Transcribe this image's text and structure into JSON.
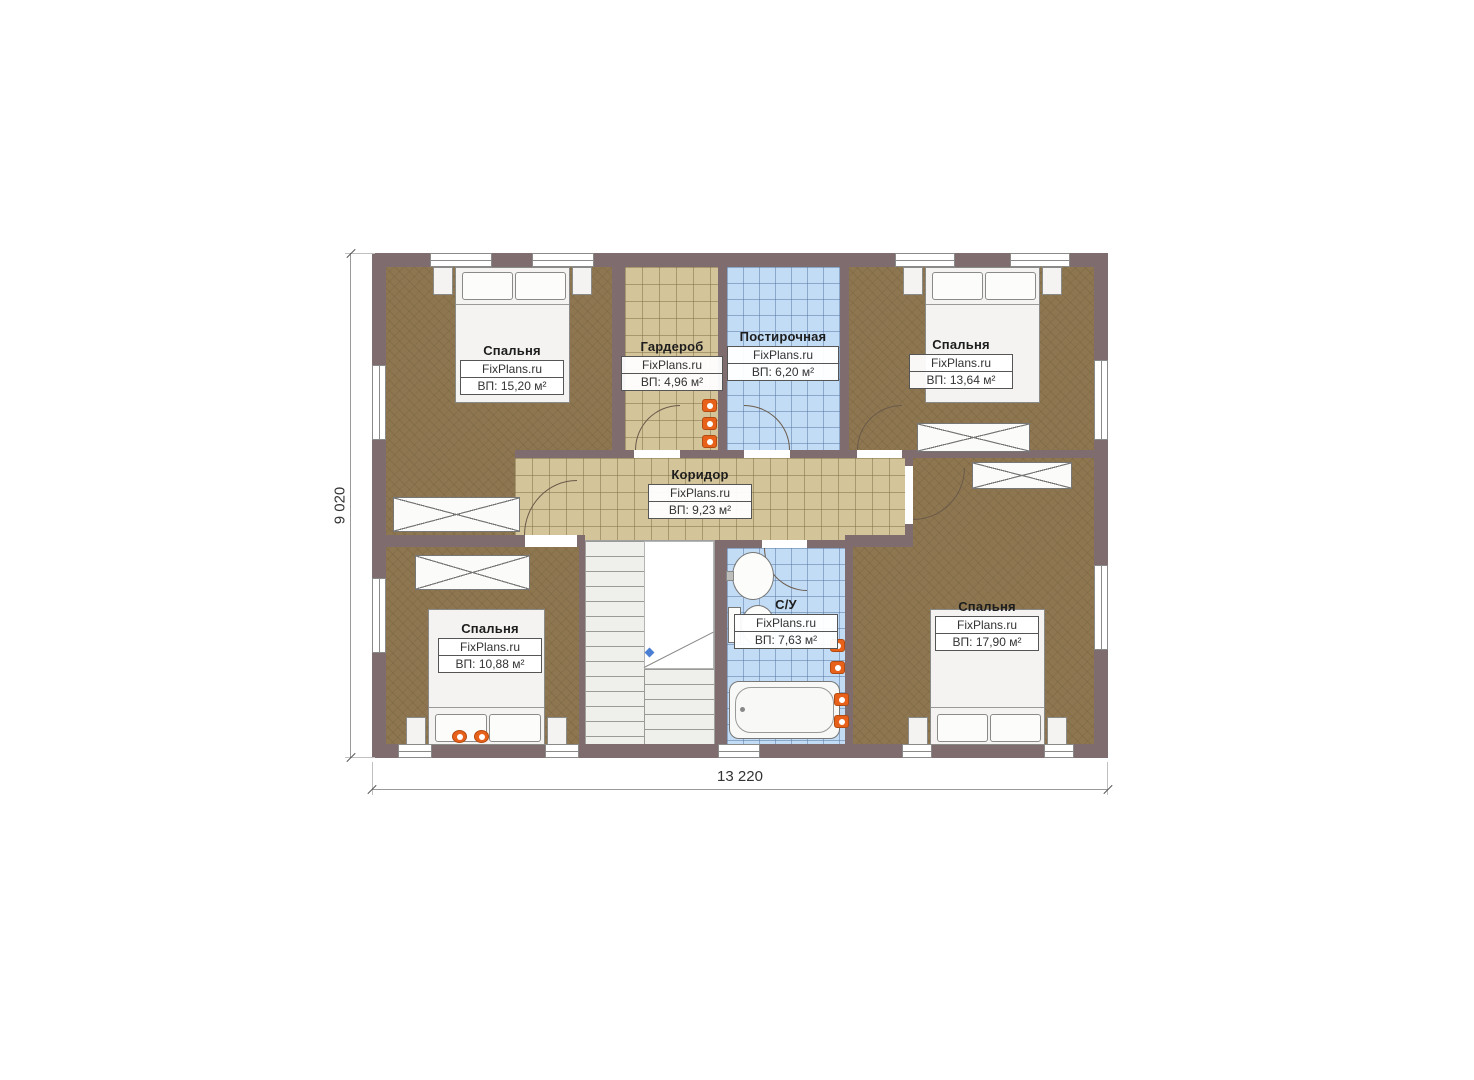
{
  "plan": {
    "watermark": "FixPlans.ru",
    "dimensions": {
      "width": "13 220",
      "height": "9 020"
    },
    "colors": {
      "wall": "#7e6c6e",
      "wood_floor": "#8d7650",
      "tile_floor": "#d4c499",
      "wet_floor": "#c2dcf5",
      "outlet_icon": "#e8611a",
      "stair_marker": "#4a7fd4"
    },
    "rooms": [
      {
        "key": "bedroom-top-left",
        "name": "Спальня",
        "brand": "FixPlans.ru",
        "area": "ВП: 15,20 м²"
      },
      {
        "key": "wardrobe",
        "name": "Гардероб",
        "brand": "FixPlans.ru",
        "area": "ВП: 4,96 м²"
      },
      {
        "key": "laundry",
        "name": "Постирочная",
        "brand": "FixPlans.ru",
        "area": "ВП: 6,20 м²"
      },
      {
        "key": "bedroom-top-right",
        "name": "Спальня",
        "brand": "FixPlans.ru",
        "area": "ВП: 13,64 м²"
      },
      {
        "key": "corridor",
        "name": "Коридор",
        "brand": "FixPlans.ru",
        "area": "ВП: 9,23 м²"
      },
      {
        "key": "bedroom-bottom-left",
        "name": "Спальня",
        "brand": "FixPlans.ru",
        "area": "ВП: 10,88 м²"
      },
      {
        "key": "bathroom",
        "name": "С/У",
        "brand": "FixPlans.ru",
        "area": "ВП: 7,63 м²"
      },
      {
        "key": "bedroom-bottom-right",
        "name": "Спальня",
        "brand": "FixPlans.ru",
        "area": "ВП: 17,90 м²"
      }
    ]
  }
}
